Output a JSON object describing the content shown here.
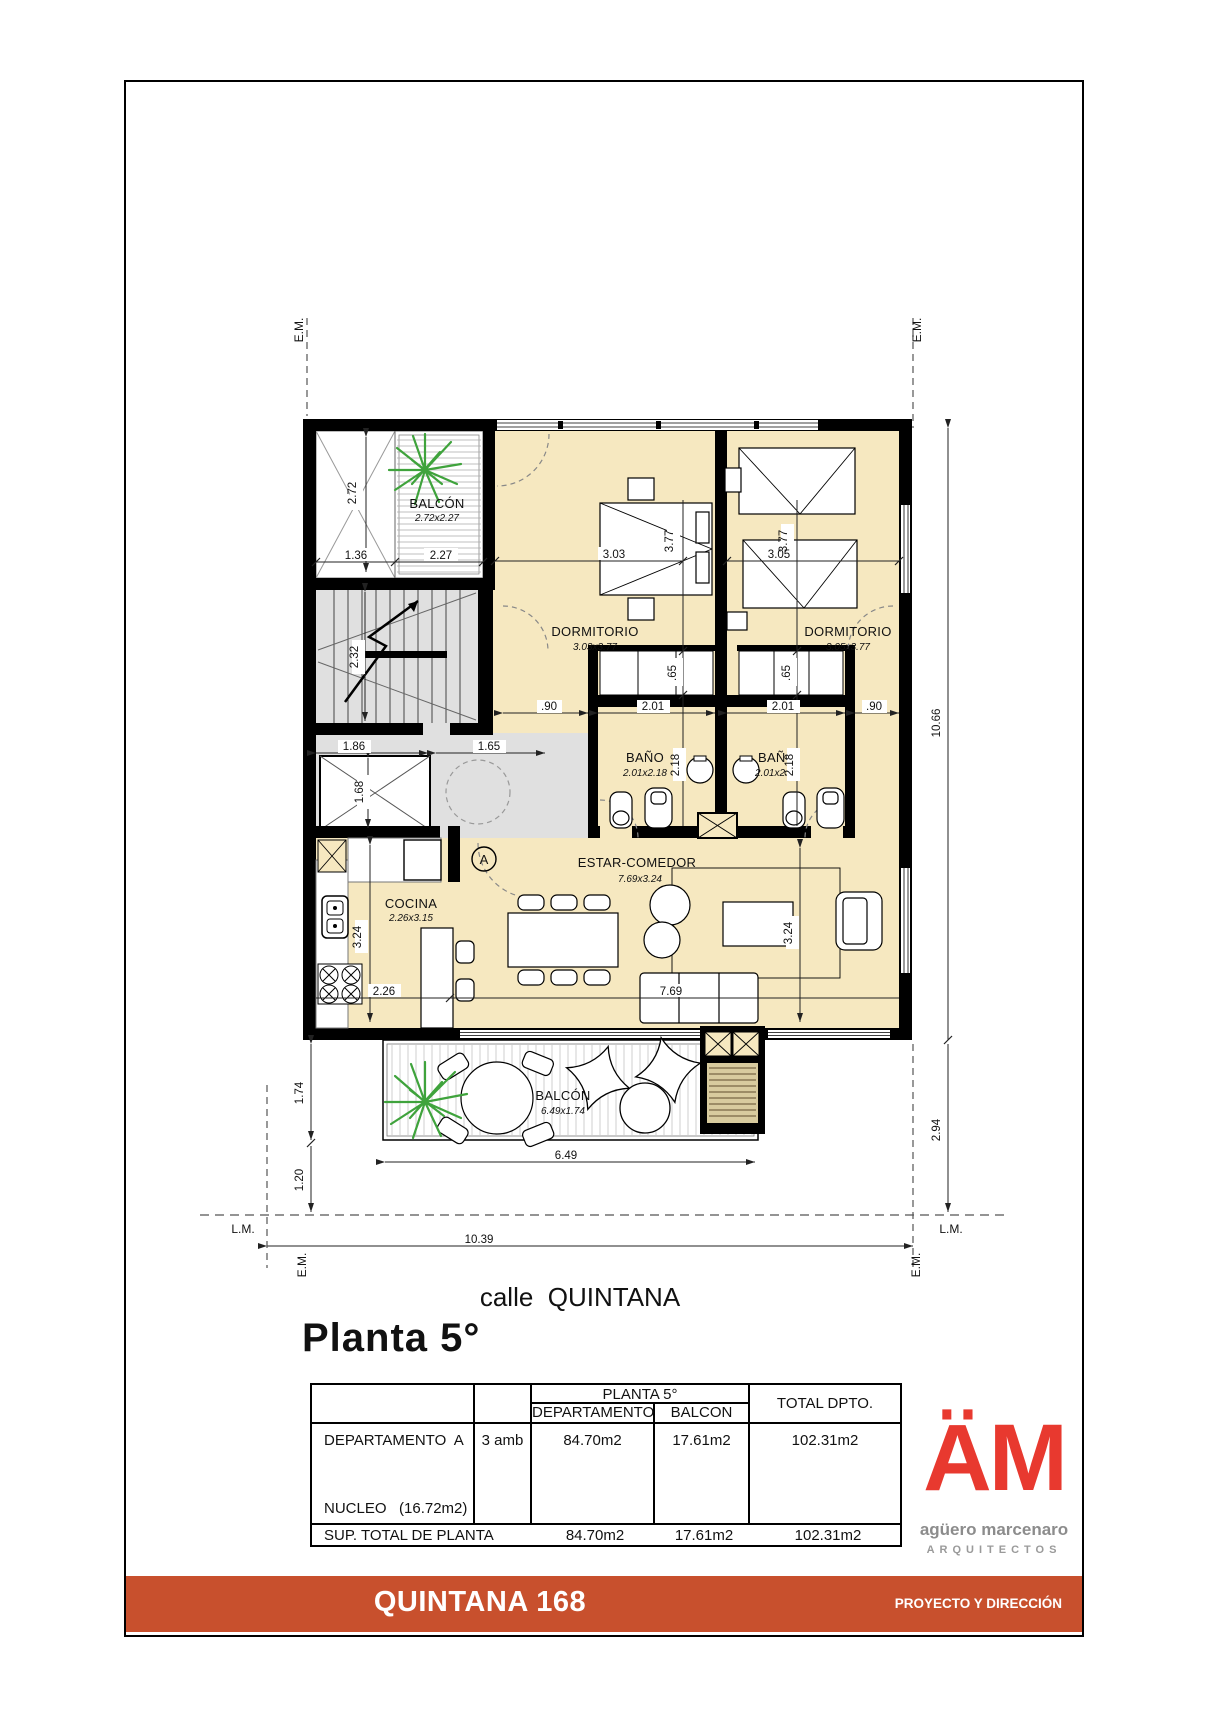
{
  "page": {
    "street_label": "calle  QUINTANA",
    "plan_title": "Planta 5°"
  },
  "plan": {
    "rooms": {
      "balcon_top": {
        "name": "BALCÓN",
        "size": "2.72x2.27"
      },
      "dormitorio1": {
        "name": "DORMITORIO",
        "size": "3.03x3.77"
      },
      "dormitorio2": {
        "name": "DORMITORIO",
        "size": "3.05x3.77"
      },
      "bano1": {
        "name": "BAÑO",
        "size": "2.01x2.18"
      },
      "bano2": {
        "name": "BAÑO",
        "size": "2.01x2.18"
      },
      "estar_comedor": {
        "name": "ESTAR-COMEDOR",
        "size": "7.69x3.24"
      },
      "cocina": {
        "name": "COCINA",
        "size": "2.26x3.15"
      },
      "balcon_bottom": {
        "name": "BALCÓN",
        "size": "6.49x1.74"
      }
    },
    "dims": {
      "d272": "2.72",
      "d136": "1.36",
      "d227": "2.27",
      "d303": "3.03",
      "d377": "3.77",
      "d305": "3.05",
      "d232": "2.32",
      "d186": "1.86",
      "d165": "1.65",
      "d168": "1.68",
      "d90": ".90",
      "d201": "2.01",
      "d65": ".65",
      "d218": "2.18",
      "d324": "3.24",
      "d226": "2.26",
      "d769": "7.69",
      "d174": "1.74",
      "d120": "1.20",
      "d649": "6.49",
      "d1039": "10.39",
      "d1066": "10.66",
      "d294": "2.94"
    },
    "markers": {
      "em": "E.M.",
      "lm": "L.M.",
      "entry": "A"
    }
  },
  "table": {
    "header": {
      "planta": "PLANTA 5°",
      "departamento": "DEPARTAMENTO",
      "balcon": "BALCON",
      "total": "TOTAL DPTO."
    },
    "row": {
      "name": "DEPARTAMENTO  A",
      "amb": "3 amb",
      "dep": "84.70m2",
      "bal": "17.61m2",
      "tot": "102.31m2"
    },
    "nucleo": "NUCLEO   (16.72m2)",
    "total_row": {
      "label": "SUP. TOTAL DE PLANTA",
      "dep": "84.70m2",
      "bal": "17.61m2",
      "tot": "102.31m2"
    }
  },
  "logo": {
    "monogram": "ÄM",
    "name": "agüero marcenaro",
    "subtitle": "ARQUITECTOS"
  },
  "footer": {
    "project": "QUINTANA 168",
    "role": "PROYECTO Y DIRECCIÓN"
  },
  "colors": {
    "accent_orange": "#C8502D",
    "logo_red": "#E8392F",
    "plan_cream": "#F6E8C0",
    "core_gray": "#E0E0E0",
    "plant_green": "#3FA33C",
    "ac_tan": "#D8CB9E"
  }
}
